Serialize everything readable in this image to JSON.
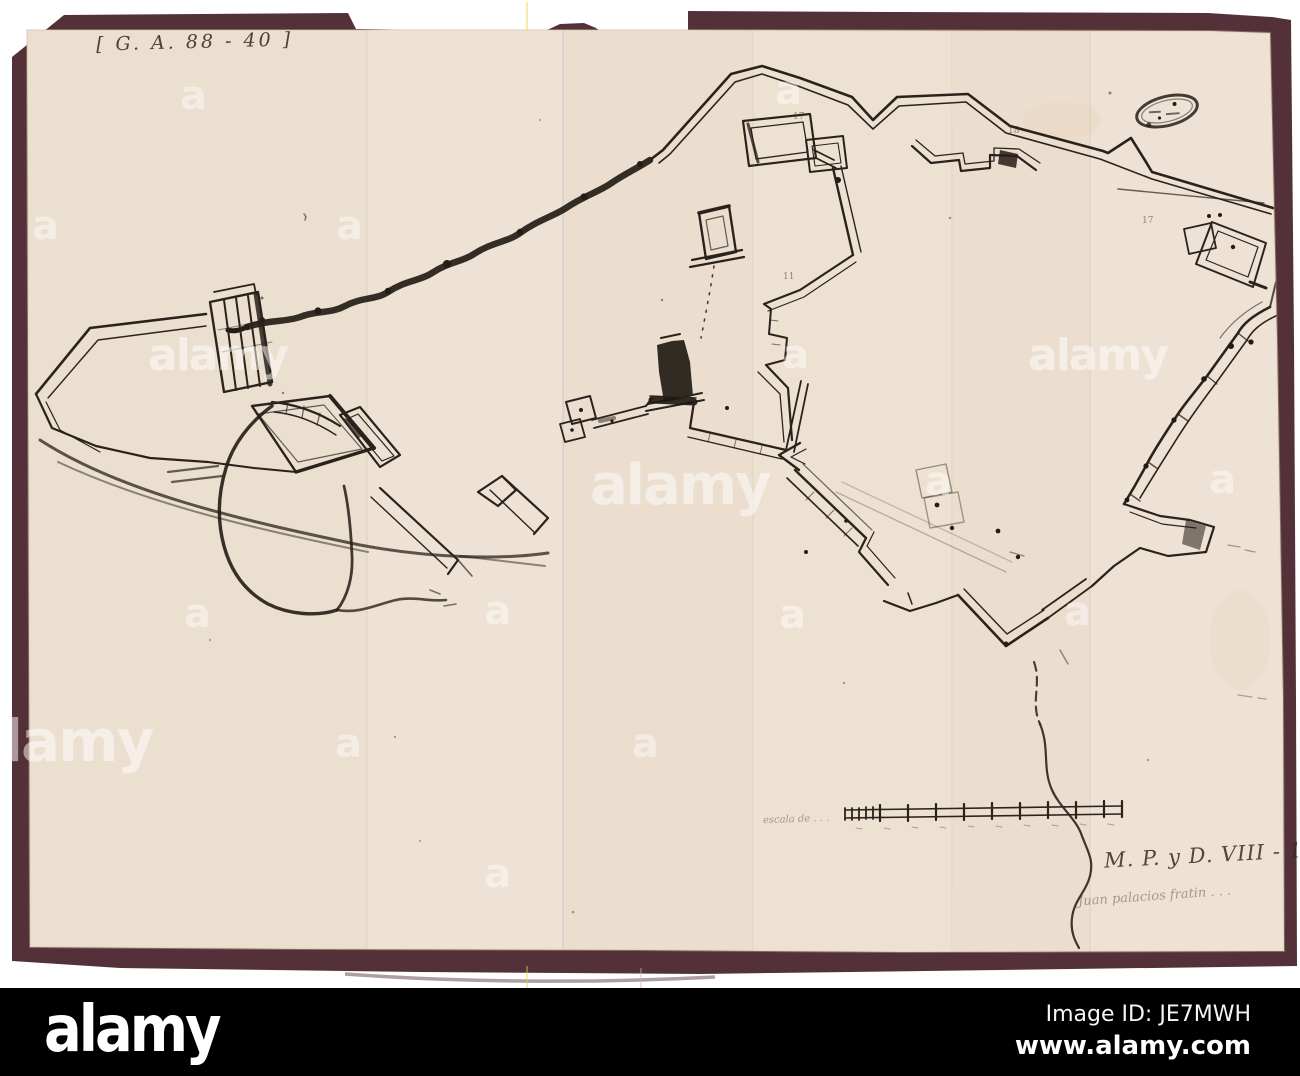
{
  "photo": {
    "description": "photographed manuscript plan of bastioned fortifications mounted on maroon board",
    "mount_color": "#543139",
    "paper_color": "#ece0d1",
    "ink_color": "#2a231c",
    "archive_ref": "[ G. A. 88 - 40 ]",
    "catalog_ref": "M. P. y D. VIII - 19",
    "signature_note": "Juan palacios fratin . . .",
    "scale_label": "escala de . . .",
    "plan_marks": [
      {
        "t": "17"
      },
      {
        "t": "18"
      },
      {
        "t": "11"
      },
      {
        "t": "17"
      }
    ]
  },
  "watermark": {
    "word": "alamy",
    "glyph": "a",
    "color": "#ffffff"
  },
  "footer": {
    "logo": "alamy",
    "image_id": "Image ID: JE7MWH",
    "url": "www.alamy.com",
    "background": "#000000"
  }
}
